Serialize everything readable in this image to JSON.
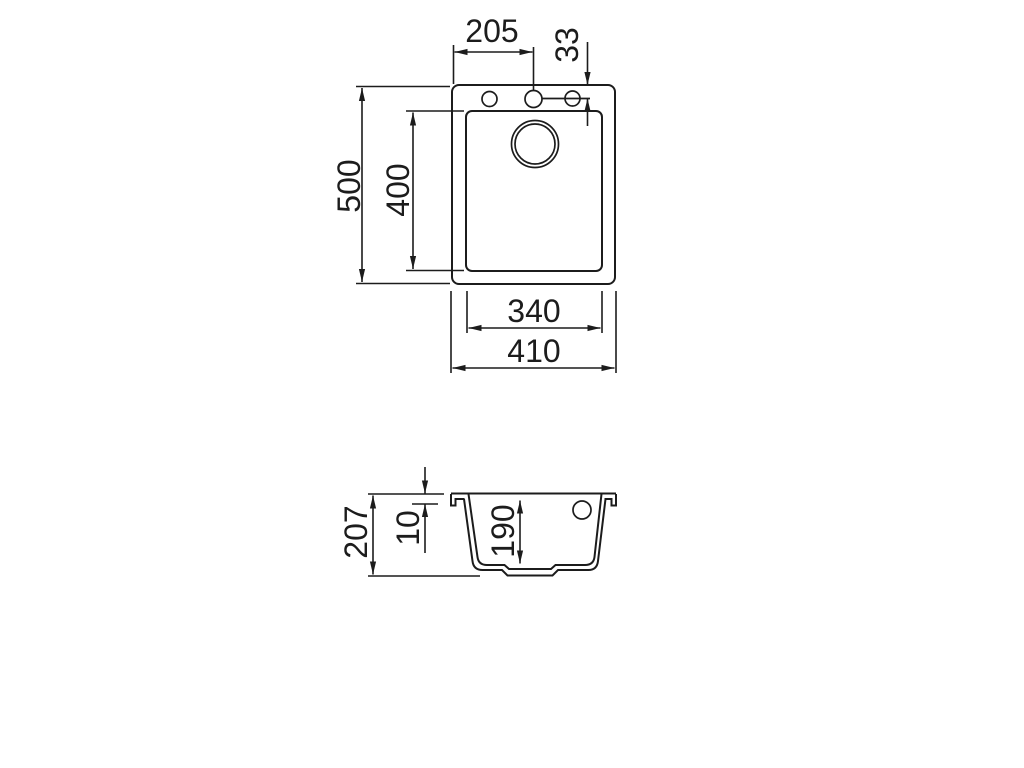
{
  "page": {
    "background": "#ffffff",
    "line_color": "#1c1c1c"
  },
  "drawing": {
    "type": "sink technical drawing",
    "views": {
      "top_view": {
        "dimensions": {
          "tap_center_from_left": "205",
          "tap_center_from_top": "33",
          "outer_depth": "500",
          "bowl_depth": "400",
          "bowl_width": "340",
          "outer_width": "410"
        }
      },
      "section_view": {
        "dimensions": {
          "total_height": "207",
          "rim_height": "10",
          "bowl_inner_depth": "190"
        }
      }
    }
  }
}
